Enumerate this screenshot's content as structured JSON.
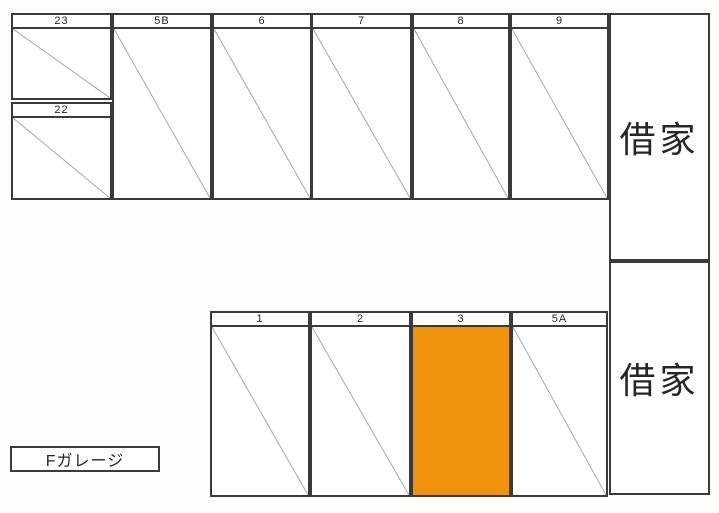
{
  "colors": {
    "line": "#3a3a3a",
    "diagonal": "#a8a8a8",
    "highlight": "#f0920b",
    "paper": "#fdfdfc",
    "text": "#2c2c2c"
  },
  "legend": {
    "label": "Fガレージ"
  },
  "houses": [
    {
      "label": "借家"
    },
    {
      "label": "借家"
    }
  ],
  "spaces": [
    {
      "label": "23",
      "highlighted": false
    },
    {
      "label": "22",
      "highlighted": false
    },
    {
      "label": "5B",
      "highlighted": false
    },
    {
      "label": "6",
      "highlighted": false
    },
    {
      "label": "7",
      "highlighted": false
    },
    {
      "label": "8",
      "highlighted": false
    },
    {
      "label": "9",
      "highlighted": false
    },
    {
      "label": "1",
      "highlighted": false
    },
    {
      "label": "2",
      "highlighted": false
    },
    {
      "label": "3",
      "highlighted": true
    },
    {
      "label": "5A",
      "highlighted": false
    }
  ]
}
